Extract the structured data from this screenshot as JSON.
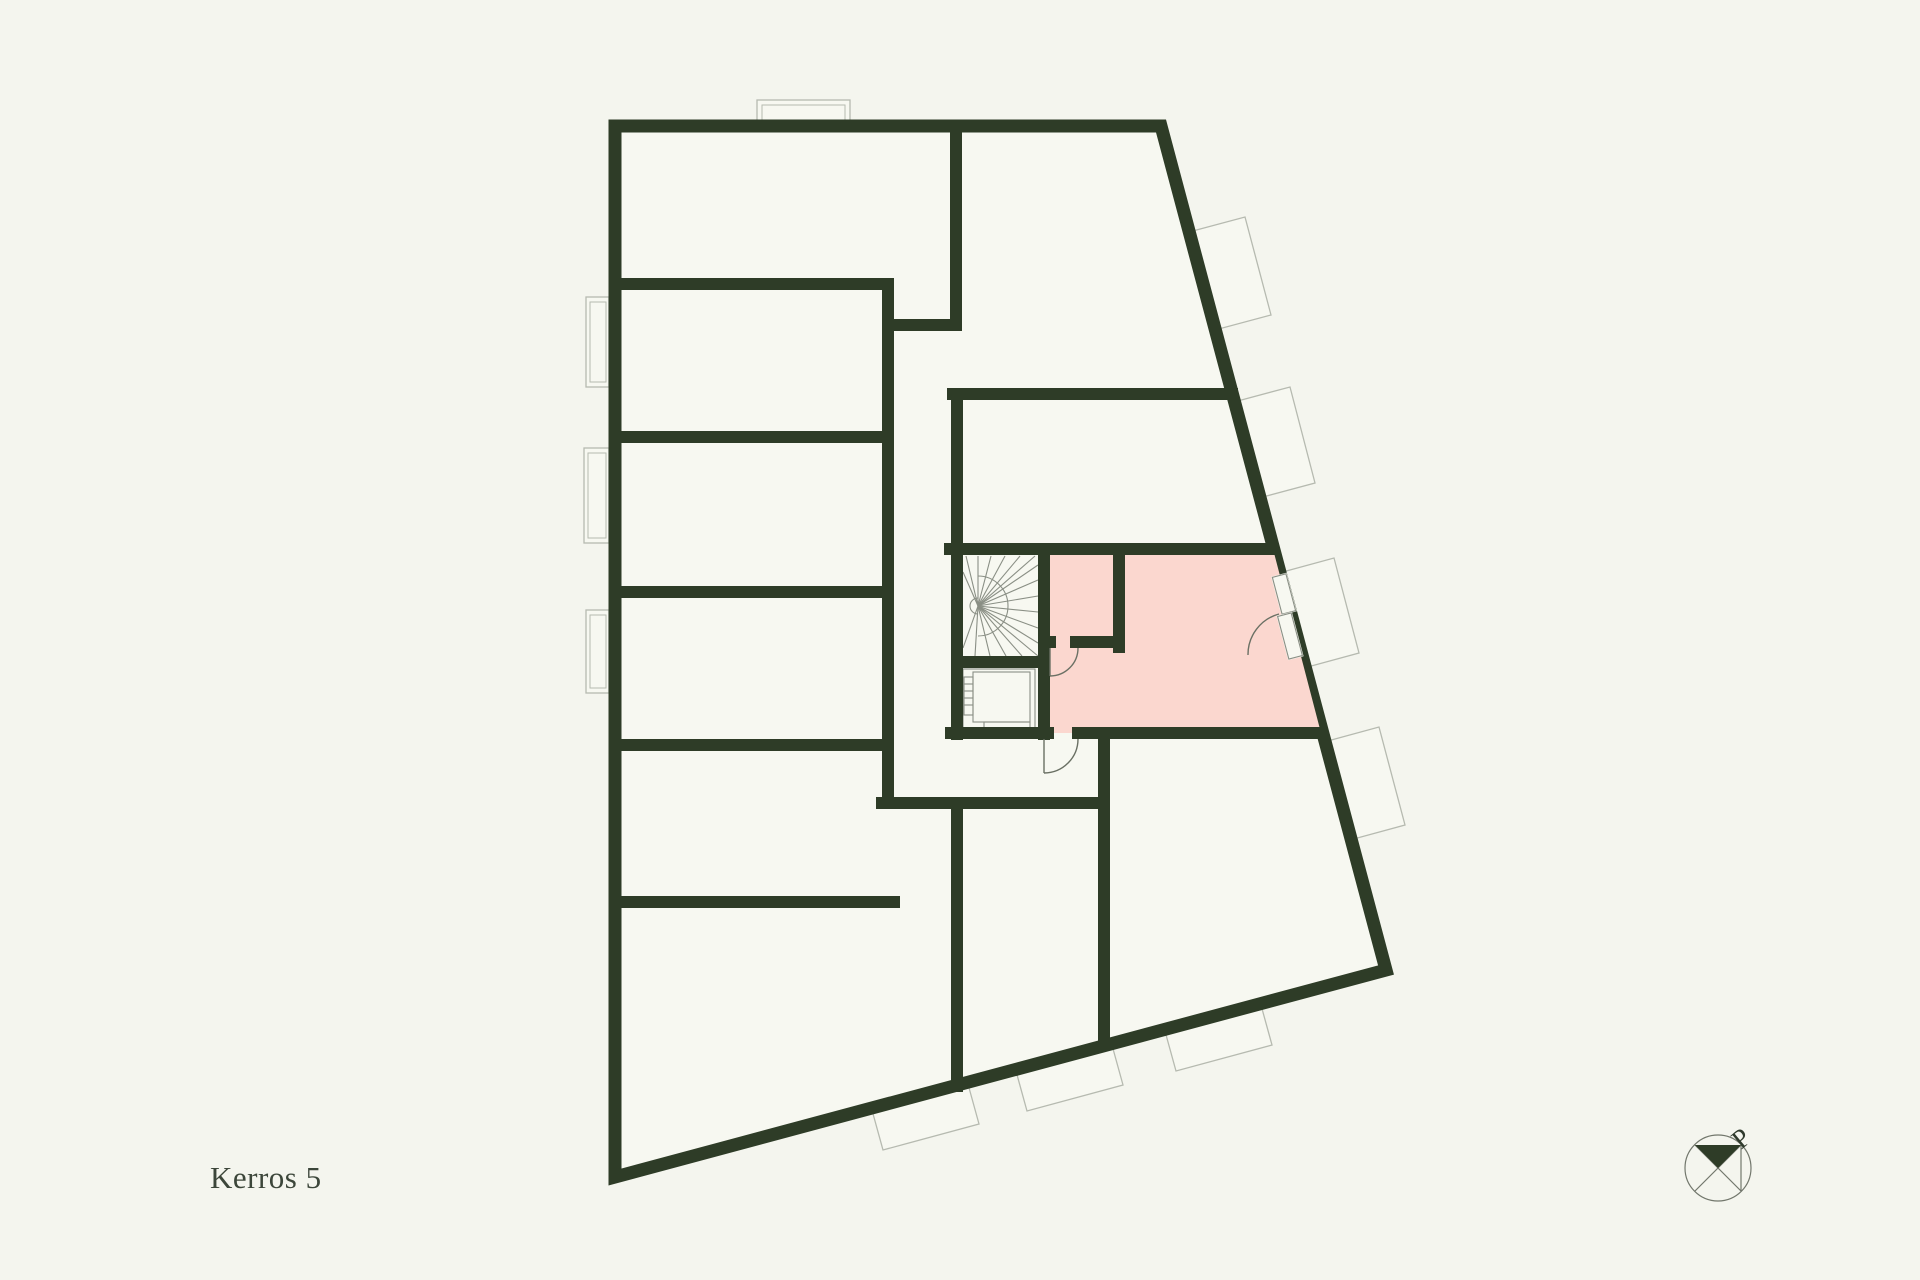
{
  "page": {
    "title": "Kerros 5"
  },
  "floor_plan": {
    "floor_label": "Kerros 5",
    "highlighted_apartment": "pink-highlighted apartment with entry hall, walk-in closet and balcony",
    "compass": {
      "label": "P",
      "meaning": "north-arrow"
    },
    "elements": {
      "stairs_icon": "spiral-staircase",
      "elevator_icon": "elevator",
      "door_icon": "door-swing-arc",
      "balcony_icon": "balcony-outline",
      "compass_icon": "north-compass"
    },
    "colors": {
      "background": "#f4f5ee",
      "wall": "#2e3c27",
      "room_fill": "#f7f8f1",
      "highlight": "#fbd7cf",
      "balcony_line": "#b6bab0",
      "detail_line": "#8a8f85",
      "arc_line": "#6a7064",
      "text": "#3c463a"
    }
  }
}
